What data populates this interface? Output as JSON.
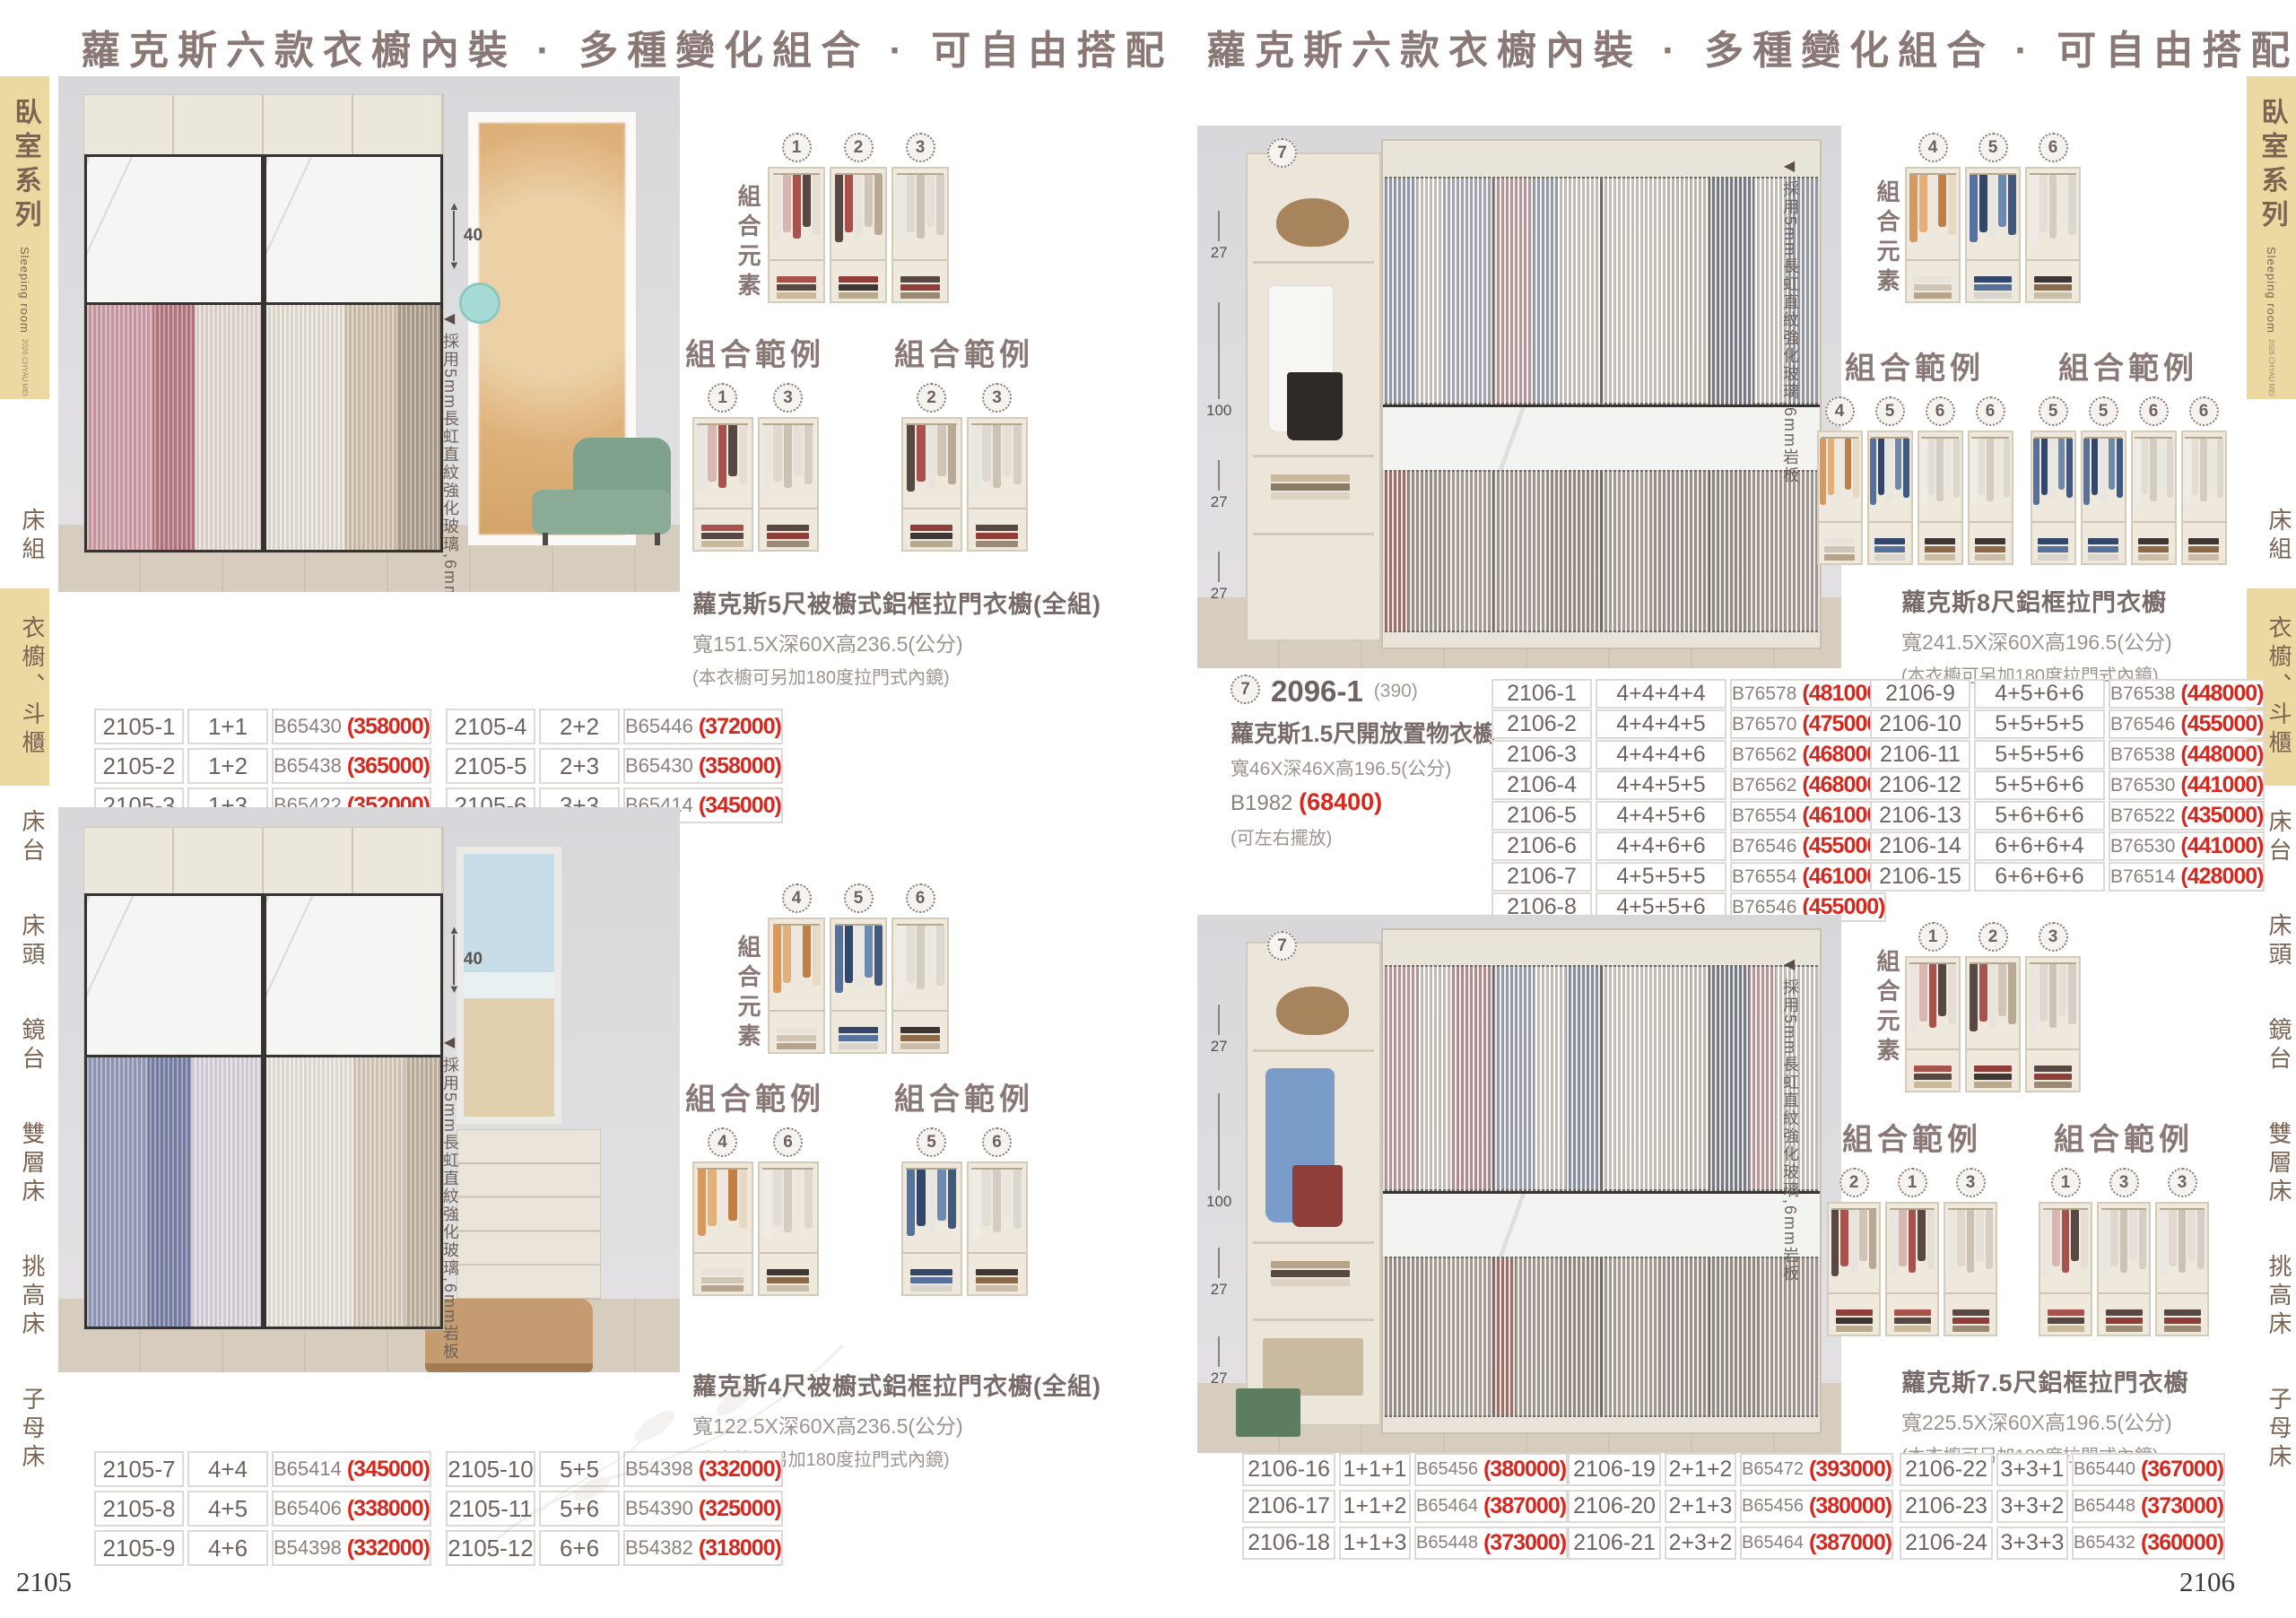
{
  "title": "蘿克斯六款衣櫥內裝 · 多種變化組合 · 可自由搭配",
  "labels": {
    "elements": "組合元素",
    "example": "組合範例"
  },
  "glass_note": "採用5mm長虹直紋強化玻璃,6mm岩板",
  "glass_note_arrow": "◀",
  "sidebar": {
    "series": "臥室系列",
    "series_en": "Sleeping room",
    "edition": "2026 CHYAU MEI",
    "items": [
      {
        "label": "床組",
        "active": false
      },
      {
        "label": "衣櫥、斗櫃",
        "active": true
      },
      {
        "label": "床台",
        "active": false
      },
      {
        "label": "床頭",
        "active": false
      },
      {
        "label": "鏡台",
        "active": false
      },
      {
        "label": "雙層床",
        "active": false
      },
      {
        "label": "挑高床",
        "active": false
      },
      {
        "label": "子母床",
        "active": false
      }
    ]
  },
  "left": {
    "page_number": "2105",
    "top": {
      "dim": "40",
      "element_ids": [
        "1",
        "2",
        "3"
      ],
      "examples": [
        [
          "1",
          "3"
        ],
        [
          "2",
          "3"
        ]
      ],
      "product": {
        "name": "蘿克斯5尺被櫥式鋁框拉門衣櫥(全組)",
        "size": "寬151.5X深60X高236.5(公分)",
        "note": "(本衣櫥可另加180度拉門式內鏡)"
      },
      "tables": [
        [
          [
            "2105-1",
            "1+1",
            "B65430",
            "(358000)"
          ],
          [
            "2105-2",
            "1+2",
            "B65438",
            "(365000)"
          ],
          [
            "2105-3",
            "1+3",
            "B65422",
            "(352000)"
          ]
        ],
        [
          [
            "2105-4",
            "2+2",
            "B65446",
            "(372000)"
          ],
          [
            "2105-5",
            "2+3",
            "B65430",
            "(358000)"
          ],
          [
            "2105-6",
            "3+3",
            "B65414",
            "(345000)"
          ]
        ]
      ]
    },
    "bottom": {
      "dim": "40",
      "element_ids": [
        "4",
        "5",
        "6"
      ],
      "examples": [
        [
          "4",
          "6"
        ],
        [
          "5",
          "6"
        ]
      ],
      "product": {
        "name": "蘿克斯4尺被櫥式鋁框拉門衣櫥(全組)",
        "size": "寬122.5X深60X高236.5(公分)",
        "note": "(本衣櫥可另加180度拉門式內鏡)"
      },
      "tables": [
        [
          [
            "2105-7",
            "4+4",
            "B65414",
            "(345000)"
          ],
          [
            "2105-8",
            "4+5",
            "B65406",
            "(338000)"
          ],
          [
            "2105-9",
            "4+6",
            "B54398",
            "(332000)"
          ]
        ],
        [
          [
            "2105-10",
            "5+5",
            "B54398",
            "(332000)"
          ],
          [
            "2105-11",
            "5+6",
            "B54390",
            "(325000)"
          ],
          [
            "2105-12",
            "6+6",
            "B54382",
            "(318000)"
          ]
        ]
      ]
    }
  },
  "right": {
    "page_number": "2106",
    "top": {
      "circle": "7",
      "measurements": [
        "27",
        "100",
        "27",
        "27"
      ],
      "element_ids": [
        "4",
        "5",
        "6"
      ],
      "examples": [
        [
          "4",
          "5",
          "6",
          "6"
        ],
        [
          "5",
          "5",
          "6",
          "6"
        ]
      ],
      "side_product": {
        "circle": "7",
        "code": "2096-1",
        "code_note": "(390)",
        "name": "蘿克斯1.5尺開放置物衣櫥",
        "size": "寬46X深46X高196.5(公分)",
        "bcode": "B1982",
        "price": "(68400)",
        "note": "(可左右擺放)"
      },
      "product": {
        "name": "蘿克斯8尺鋁框拉門衣櫥",
        "size": "寬241.5X深60X高196.5(公分)",
        "note": "(本衣櫥可另加180度拉門式內鏡)"
      },
      "tables": [
        [
          [
            "2106-1",
            "4+4+4+4",
            "B76578",
            "(481000)"
          ],
          [
            "2106-2",
            "4+4+4+5",
            "B76570",
            "(475000)"
          ],
          [
            "2106-3",
            "4+4+4+6",
            "B76562",
            "(468000)"
          ],
          [
            "2106-4",
            "4+4+5+5",
            "B76562",
            "(468000)"
          ],
          [
            "2106-5",
            "4+4+5+6",
            "B76554",
            "(461000)"
          ],
          [
            "2106-6",
            "4+4+6+6",
            "B76546",
            "(455000)"
          ],
          [
            "2106-7",
            "4+5+5+5",
            "B76554",
            "(461000)"
          ],
          [
            "2106-8",
            "4+5+5+6",
            "B76546",
            "(455000)"
          ]
        ],
        [
          [
            "2106-9",
            "4+5+6+6",
            "B76538",
            "(448000)"
          ],
          [
            "2106-10",
            "5+5+5+5",
            "B76546",
            "(455000)"
          ],
          [
            "2106-11",
            "5+5+5+6",
            "B76538",
            "(448000)"
          ],
          [
            "2106-12",
            "5+5+6+6",
            "B76530",
            "(441000)"
          ],
          [
            "2106-13",
            "5+6+6+6",
            "B76522",
            "(435000)"
          ],
          [
            "2106-14",
            "6+6+6+4",
            "B76530",
            "(441000)"
          ],
          [
            "2106-15",
            "6+6+6+6",
            "B76514",
            "(428000)"
          ]
        ]
      ]
    },
    "bottom": {
      "circle": "7",
      "measurements": [
        "27",
        "100",
        "27",
        "27"
      ],
      "element_ids": [
        "1",
        "2",
        "3"
      ],
      "examples": [
        [
          "2",
          "1",
          "3"
        ],
        [
          "1",
          "3",
          "3"
        ]
      ],
      "product": {
        "name": "蘿克斯7.5尺鋁框拉門衣櫥",
        "size": "寬225.5X深60X高196.5(公分)",
        "note": "(本衣櫥可另加180度拉門式內鏡)"
      },
      "tables": [
        [
          [
            "2106-16",
            "1+1+1",
            "B65456",
            "(380000)"
          ],
          [
            "2106-17",
            "1+1+2",
            "B65464",
            "(387000)"
          ],
          [
            "2106-18",
            "1+1+3",
            "B65448",
            "(373000)"
          ]
        ],
        [
          [
            "2106-19",
            "2+1+2",
            "B65472",
            "(393000)"
          ],
          [
            "2106-20",
            "2+1+3",
            "B65456",
            "(380000)"
          ],
          [
            "2106-21",
            "2+3+2",
            "B65464",
            "(387000)"
          ]
        ],
        [
          [
            "2106-22",
            "3+3+1",
            "B65440",
            "(367000)"
          ],
          [
            "2106-23",
            "3+3+2",
            "B65448",
            "(373000)"
          ],
          [
            "2106-24",
            "3+3+3",
            "B65432",
            "(360000)"
          ]
        ]
      ]
    }
  },
  "wardrobe_units": {
    "1": {
      "hang": [
        "#eae6df",
        "#d8b6b2",
        "#a8524e",
        "#574844",
        "#e4ded4"
      ],
      "stack": [
        "#a8524e",
        "#574844",
        "#c9b89a"
      ]
    },
    "2": {
      "hang": [
        "#574844",
        "#a8524e",
        "#e8e3db",
        "#cfc5b8",
        "#b8a894"
      ],
      "stack": [
        "#8f3e3a",
        "#3e3632",
        "#b8a88e"
      ]
    },
    "3": {
      "hang": [
        "#eae7e1",
        "#ded8cf",
        "#cac2b5",
        "#e4e0d8",
        "#d4cec4"
      ],
      "stack": [
        "#574844",
        "#8f3e3a",
        "#9a8a74"
      ]
    },
    "4": {
      "hang": [
        "#d79a5e",
        "#e2b07a",
        "#ecE7df",
        "#c27f43",
        "#e8d9c4"
      ],
      "stack": [
        "#e8e3da",
        "#cfc5b6",
        "#b5a38c"
      ]
    },
    "5": {
      "hang": [
        "#55719c",
        "#32476b",
        "#e8e6e1",
        "#6d89ad",
        "#42597e"
      ],
      "stack": [
        "#32476b",
        "#55719c",
        "#d8d4cc"
      ]
    },
    "6": {
      "hang": [
        "#efece7",
        "#e2ded6",
        "#d2ccc2",
        "#eae7e1",
        "#ddd8ce"
      ],
      "stack": [
        "#3e3632",
        "#8a6a48",
        "#c9bda8"
      ]
    }
  }
}
